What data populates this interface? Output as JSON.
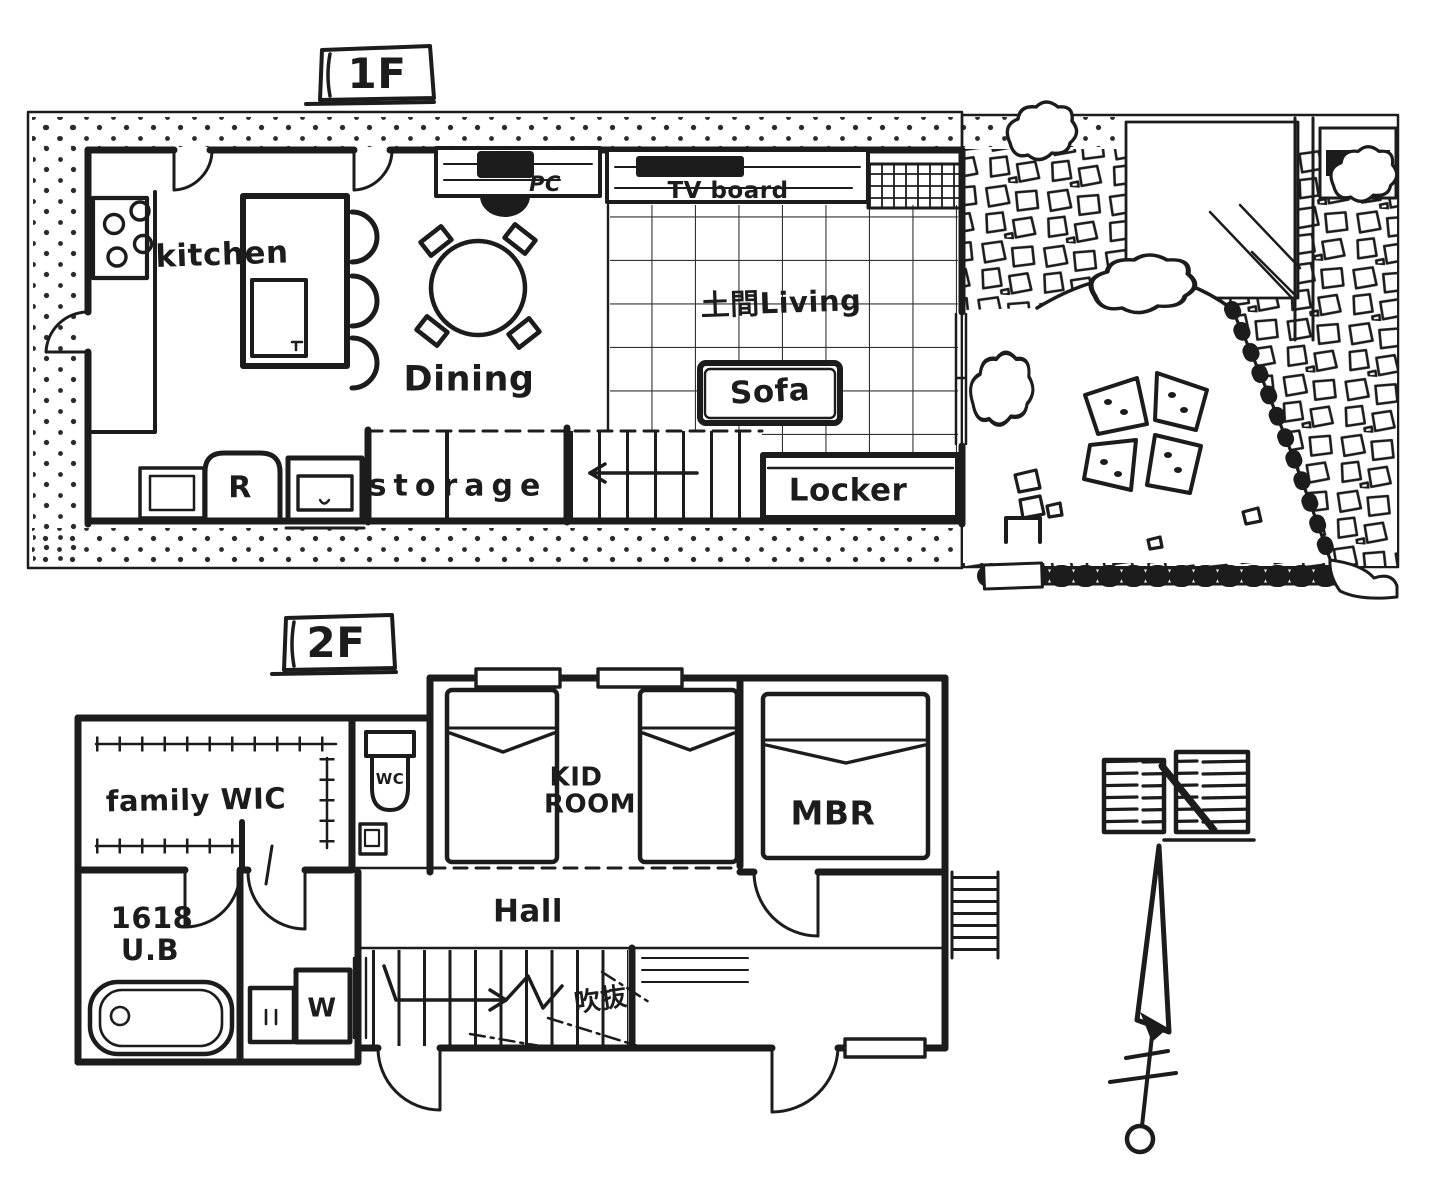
{
  "canvas": {
    "ink": "#1c1c1c",
    "paper": "#ffffff"
  },
  "floor1": {
    "title": "1F",
    "labels": {
      "kitchen": "kitchen",
      "dining": "Dining",
      "pc": "PC",
      "tv_board": "TV board",
      "doma_living": "土間Living",
      "sofa": "Sofa",
      "locker": "Locker",
      "storage": "storage",
      "refrigerator": "R"
    }
  },
  "floor2": {
    "title": "2F",
    "labels": {
      "family_wic": "family WIC",
      "wc": "WC",
      "kid_room_line1": "KID",
      "kid_room_line2": "ROOM",
      "mbr": "MBR",
      "hall": "Hall",
      "unit_bath_line1": "1618",
      "unit_bath_line2": "U.B",
      "washer": "W",
      "void": "吹抜"
    }
  },
  "compass": {
    "label": "N"
  }
}
